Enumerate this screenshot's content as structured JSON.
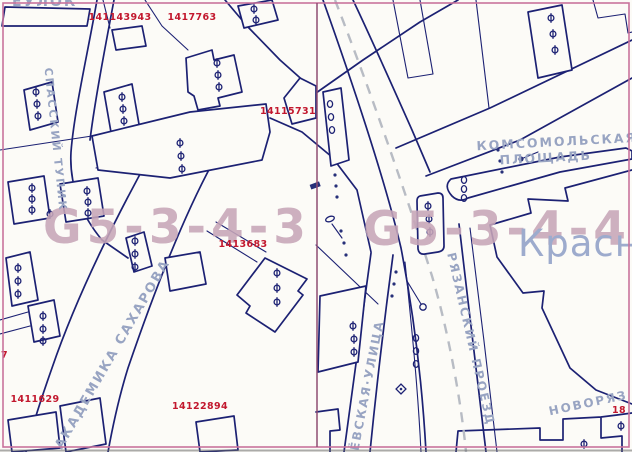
{
  "map": {
    "sheet_codes": {
      "left": "G5-3-4-3",
      "right": "G5-3-4-4"
    },
    "area_labels": {
      "krasn_partial": "Красн",
      "komsomolskaya_line1": "КОМСОМОЛЬСКАЯ",
      "komsomolskaya_line2": "ПЛОЩАДЬ"
    },
    "streets": {
      "spassky_tupik": "СПАССКИЙ ТУПИК",
      "akademika_sakharova": "АКАДЕМИКА САХАРОВА",
      "kalanchevskaya_partial": "ЁВСКАЯ·УЛИЦА",
      "ryazansky_proezd": "РЯЗАНСКИЙ ПРОЕЗД",
      "novoryazanskaya_partial": "НОВОРЯЗ",
      "pereulok_partial": "ЕУЛОК"
    },
    "cadastral_numbers": [
      "141143943",
      "1417763",
      "14115731",
      "1413683",
      "1411629",
      "14122894",
      "7",
      "18"
    ],
    "symbols": {
      "building_point": "Ф"
    },
    "colors": {
      "line": "#1c2173",
      "street_text": "#98a4c2",
      "cadastral_text": "#c2182e",
      "watermark": "#c7a6b8",
      "frame": "#c9739c",
      "sheet_divider": "#8f4c72",
      "dashed_centerline": "#b8bcc4",
      "paper": "#fcfbf7"
    }
  }
}
